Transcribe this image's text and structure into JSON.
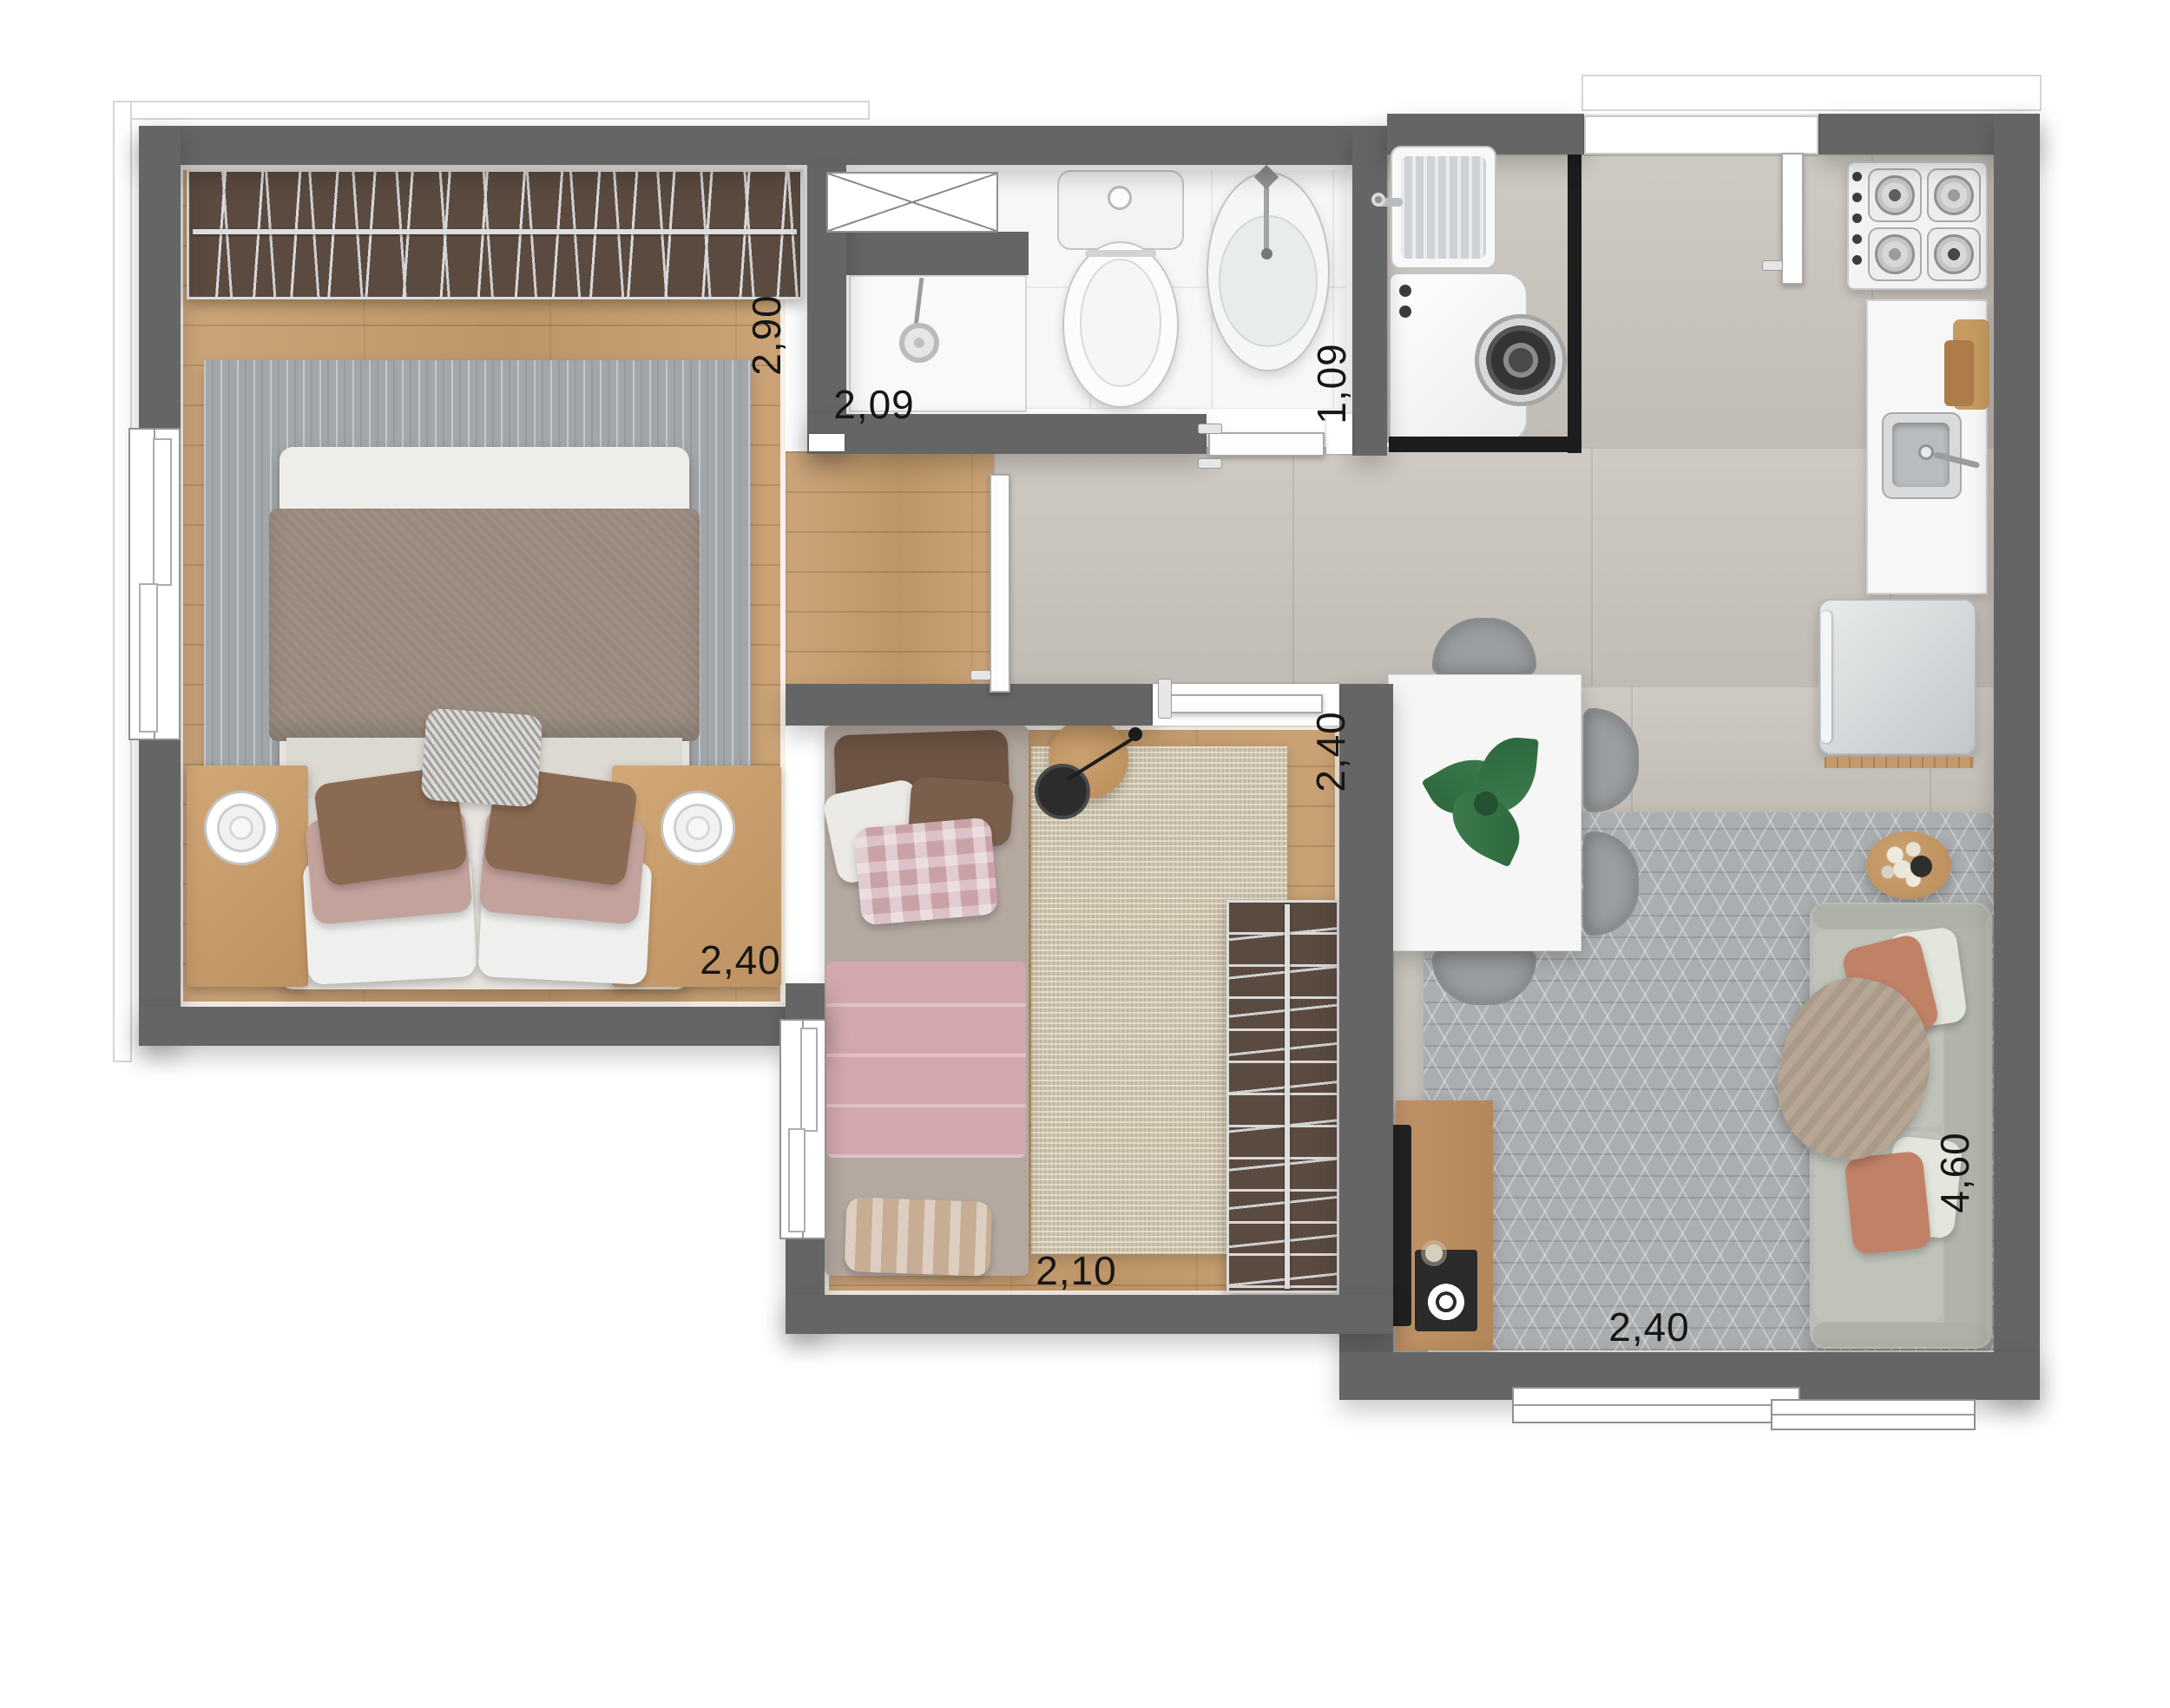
{
  "plan": {
    "type": "apartment-floor-plan",
    "rooms": {
      "bedroom1": {
        "depth_label": "2,90",
        "width_label": "2,40"
      },
      "bathroom": {
        "width_label": "2,09",
        "depth_label": "1,09"
      },
      "bedroom2": {
        "depth_label": "2,40",
        "width_label": "2,10"
      },
      "living": {
        "width_label": "2,40",
        "depth_label": "4,60"
      }
    },
    "colors": {
      "wall": "#656565",
      "wood_floor": "#c79d6e",
      "tile_floor": "#cbc6be",
      "bath_floor": "#f6f7f8",
      "label_text": "#161616",
      "plant": "#2f6b40"
    }
  }
}
